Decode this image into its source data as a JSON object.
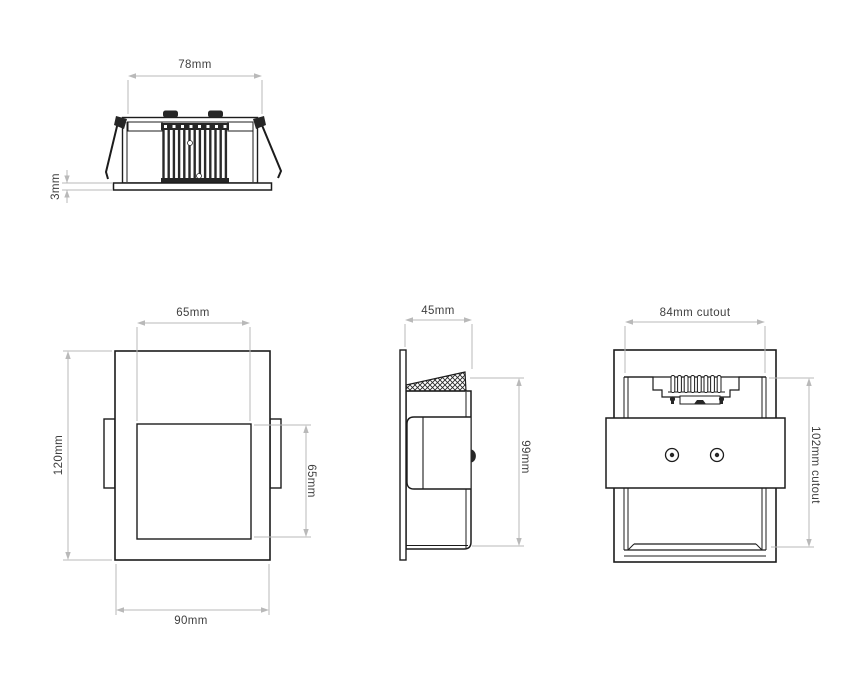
{
  "document": {
    "type": "technical-dimension-drawing",
    "subject": "square recessed wall light, four orthographic views"
  },
  "colors": {
    "background": "#ffffff",
    "drawing_line": "#1c1c1c",
    "dimension_line": "#b9b9b9",
    "label_text": "#3f3f3f"
  },
  "views": {
    "top": {
      "name": "top profile view",
      "dims": {
        "body_width": "78mm",
        "flange_thickness": "3mm"
      }
    },
    "front": {
      "name": "front view",
      "dims": {
        "aperture_width": "65mm",
        "overall_height": "120mm",
        "aperture_height": "65mm",
        "overall_width": "90mm"
      }
    },
    "side": {
      "name": "side view",
      "dims": {
        "depth": "45mm",
        "recess_height": "99mm"
      }
    },
    "rear": {
      "name": "rear view",
      "dims": {
        "cutout_width": "84mm cutout",
        "cutout_height": "102mm cutout"
      }
    }
  }
}
